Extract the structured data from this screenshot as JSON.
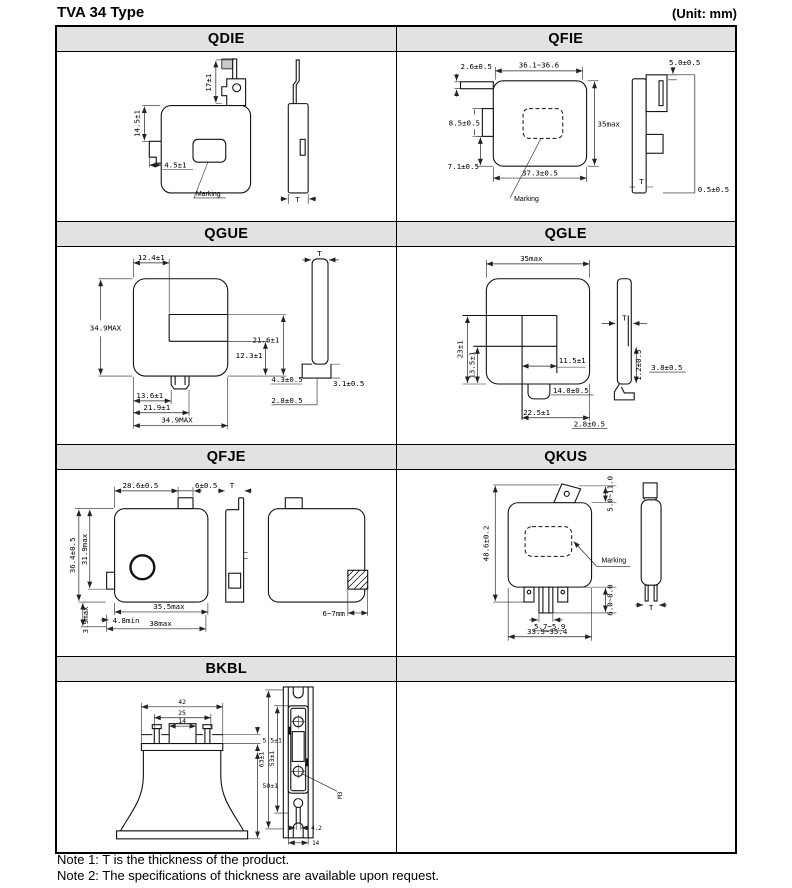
{
  "page": {
    "title": "TVA 34 Type",
    "unit": "(Unit: mm)"
  },
  "notes": [
    "Note 1: T is the thickness of the product.",
    "Note 2: The specifications of thickness are available upon request."
  ],
  "cells": {
    "qdie": {
      "header": "QDIE",
      "labels": {
        "d17": "17±1",
        "d145": "14.5±1",
        "d45": "4.5±1",
        "marking": "Marking",
        "t": "T"
      }
    },
    "qfie": {
      "header": "QFIE",
      "labels": {
        "d26": "2.6±0.5",
        "d36": "36.1~36.6",
        "d85": "8.5±0.5",
        "d35": "35max",
        "d71": "7.1±0.5",
        "d373": "37.3±0.5",
        "marking": "Marking",
        "d50": "5.0±0.5",
        "t": "T",
        "d05": "0.5±0.5"
      }
    },
    "qgue": {
      "header": "QGUE",
      "labels": {
        "d124": "12.4±1",
        "d349l": "34.9MAX",
        "d216": "21.6±1",
        "d123": "12.3±1",
        "d136": "13.6±1",
        "d219": "21.9±1",
        "d349b": "34.9MAX",
        "t": "T",
        "d43": "4.3±0.5",
        "d31": "3.1±0.5",
        "d28": "2.8±0.5"
      }
    },
    "qgle": {
      "header": "QGLE",
      "labels": {
        "d35": "35max",
        "d23": "23±1",
        "d135": "13.5±1",
        "d115": "11.5±1",
        "d140": "14.0±0.5",
        "d225": "22.5±1",
        "d28": "2.8±0.5",
        "t": "T",
        "d12": "1.2±0.5",
        "d38": "3.8±0.5"
      }
    },
    "qfje": {
      "header": "QFJE",
      "labels": {
        "d286": "28.6±0.5",
        "d6": "6±0.5",
        "t": "T",
        "d364": "36.4±0.5",
        "d319": "31.9max",
        "d39": "3.9max",
        "d48": "4.8min",
        "d355": "35.5max",
        "d38": "38max",
        "d67": "6~7mm"
      }
    },
    "qkus": {
      "header": "QKUS",
      "labels": {
        "d486": "48.6±0.2",
        "d511": "5.0~11.0",
        "marking": "Marking",
        "d68": "6.0~8.0",
        "d57": "5.7~5.9",
        "d339": "33.9~35.4",
        "t": "T"
      }
    },
    "bkbl": {
      "header": "BKBL",
      "labels": {
        "d42": "42",
        "d25": "25",
        "d14a": "14",
        "d55": "5.5±1",
        "d50": "50±1",
        "d63": "63±1",
        "d53": "53±1",
        "m3": "M3",
        "d42b": "4.2",
        "d14b": "14"
      }
    }
  }
}
